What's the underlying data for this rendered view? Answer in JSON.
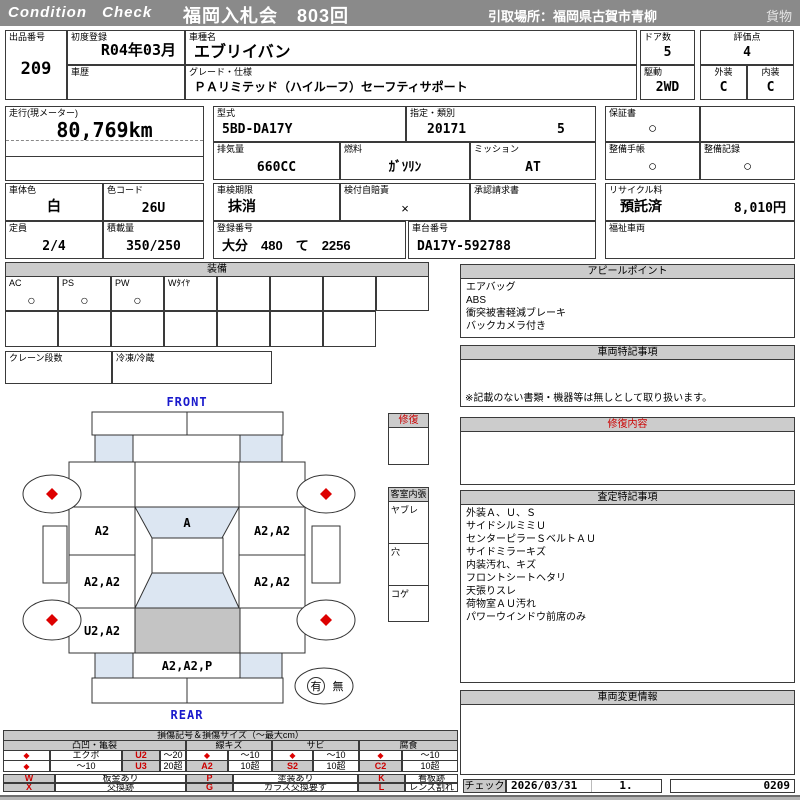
{
  "header": {
    "brand": "Condition Check",
    "auction": "福岡入札会　803回",
    "pickup": "引取場所：福岡県古賀市青柳",
    "category": "貨物"
  },
  "colors": {
    "accent_red": "#dd0000",
    "topbar_gray": "#8a8a8a",
    "panel_gray": "#cccccc",
    "window_blue": "#dce6f2",
    "roof_gray": "#c4c4c4",
    "label_blue": "#1a1acc"
  },
  "info": {
    "lot_label": "出品番号",
    "lot": "209",
    "first_reg_label": "初度登録",
    "first_reg": "R04年03月",
    "history_label": "車歴",
    "history": "",
    "model_label": "車種名",
    "model": "エブリイバン",
    "grade_label": "グレード・仕様",
    "grade": "ＰＡリミテッド（ハイルーフ）セーフティサポート",
    "doors_label": "ドア数",
    "doors": "5",
    "drive_label": "駆動",
    "drive": "2WD",
    "score_label": "評価点",
    "score": "4",
    "exterior_label": "外装",
    "exterior_grade": "C",
    "interior_label": "内装",
    "interior_grade": "C"
  },
  "spec": {
    "mileage_label": "走行(現メーター)",
    "mileage": "80,769km",
    "model_code_label": "型式",
    "model_code": "5BD-DA17Y",
    "class_label": "指定・類別",
    "class_no": "20171",
    "class_sub": "5",
    "warranty_label": "保証書",
    "warranty": "○",
    "displacement_label": "排気量",
    "displacement": "660CC",
    "fuel_label": "燃料",
    "fuel": "ｶﾞｿﾘﾝ",
    "mission_label": "ミッション",
    "mission": "AT",
    "book_label": "整備手帳",
    "book": "○",
    "record_label": "整備記録",
    "record": "○",
    "body_color_label": "車体色",
    "body_color": "白",
    "color_code_label": "色コード",
    "color_code": "26U",
    "inspection_label": "車検期限",
    "inspection": "抹消",
    "insurance_label": "検付自賠責",
    "insurance": "×",
    "approval_label": "承認請求書",
    "approval": "",
    "recycle_label": "リサイクル料",
    "recycle_status": "預託済",
    "recycle_fee": "8,010円",
    "capacity_label": "定員",
    "capacity": "2/4",
    "load_label": "積載量",
    "load": "350/250",
    "reg_label": "登録番号",
    "reg_no": "大分　480　て　2256",
    "chassis_label": "車台番号",
    "chassis_no": "DA17Y-592788",
    "welfare_label": "福祉車両",
    "welfare": ""
  },
  "equipment": {
    "title": "装備",
    "cells": [
      {
        "label": "AC",
        "value": "○"
      },
      {
        "label": "PS",
        "value": "○"
      },
      {
        "label": "PW",
        "value": "○"
      },
      {
        "label": "Wﾀｲﾔ",
        "value": ""
      }
    ],
    "crane_label": "クレーン段数",
    "fridge_label": "冷凍/冷蔵"
  },
  "appeal": {
    "title": "アピールポイント",
    "items": [
      "エアバッグ",
      "ABS",
      "衝突被害軽減ブレーキ",
      "バックカメラ付き"
    ]
  },
  "vehicle_notes": {
    "title": "車両特記事項",
    "note": "※記載のない書類・機器等は無しとして取り扱います。"
  },
  "repair": {
    "title": "修復内容"
  },
  "assessment": {
    "title": "査定特記事項",
    "items": [
      "外装Ａ、Ｕ、Ｓ",
      "サイドシルミミＵ",
      "センターピラーＳベルトＡＵ",
      "サイドミラーキズ",
      "内装汚れ、キズ",
      "フロントシートヘタリ",
      "天張りスレ",
      "荷物室ＡＵ汚れ",
      "パワーウインドウ前席のみ"
    ]
  },
  "change_info": {
    "title": "車両変更情報"
  },
  "diagram": {
    "front": "FRONT",
    "rear": "REAR",
    "repair_box": "修復",
    "cabin_box": "客室内張",
    "cabin_rows": [
      "ヤブレ",
      "穴",
      "コゲ"
    ],
    "windshield": "A",
    "lf_door": "A2",
    "rf_door": "A2,A2",
    "lm_door": "A2,A2",
    "rm_door": "A2,A2",
    "l_quarter": "U2,A2",
    "rear_gate": "A2,A2,P",
    "has": "有",
    "none": "無"
  },
  "legend": {
    "title": "損傷記号＆損傷サイズ（～最大cm）",
    "g1": {
      "header": "凸凹・亀裂",
      "r1": [
        "◆",
        "エクボ",
        "U2",
        "～20"
      ],
      "r2": [
        "◆",
        "～10",
        "U3",
        "20超"
      ]
    },
    "g2": {
      "header": "線キズ",
      "r1": [
        "◆",
        "～10"
      ],
      "r2": [
        "A2",
        "10超"
      ]
    },
    "g3": {
      "header": "サビ",
      "r1": [
        "◆",
        "～10"
      ],
      "r2": [
        "S2",
        "10超"
      ]
    },
    "g4": {
      "header": "腐食",
      "r1": [
        "◆",
        "～10"
      ],
      "r2": [
        "C2",
        "10超"
      ]
    },
    "codes": [
      {
        "k": "W",
        "v": "板金あり"
      },
      {
        "k": "P",
        "v": "塗装あり"
      },
      {
        "k": "K",
        "v": "看板跡"
      },
      {
        "k": "X",
        "v": "交換跡"
      },
      {
        "k": "G",
        "v": "ガラス交換要す"
      },
      {
        "k": "L",
        "v": "レンズ割れ"
      }
    ]
  },
  "footer": {
    "check_label": "チェック",
    "date": "2026/03/31",
    "seq": "1.",
    "code": "0209"
  }
}
